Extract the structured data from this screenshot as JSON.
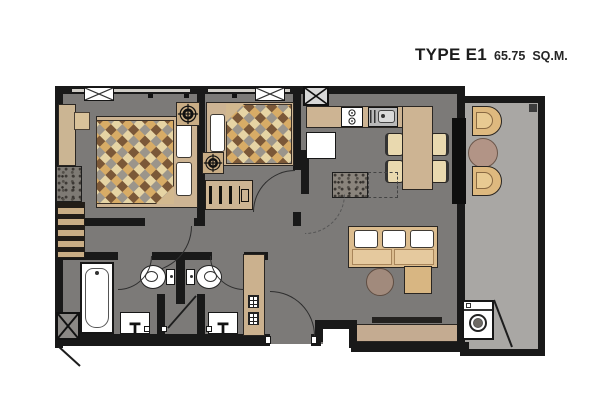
{
  "header": {
    "type_label": "TYPE E1",
    "area_value": "65.75",
    "area_unit": "SQ.M."
  },
  "colors": {
    "wall": "#191919",
    "floor": "#7c7a78",
    "balcony_floor": "#a9a7a4",
    "furniture_tan": "#cdb493",
    "furniture_cream": "#e9d9af",
    "fixture_white": "#ffffff",
    "blanket_brown": "#7b5838",
    "blanket_cream": "#e6d4a4",
    "blanket_gray": "#9b958b",
    "blanket_gold": "#d8ac66",
    "table_brown": "#a18a7c"
  },
  "plan": {
    "rooms": [
      {
        "name": "master-bedroom",
        "items": [
          "double-bed",
          "wardrobe",
          "dresser",
          "shelf-cabinet",
          "ceiling-fan",
          "air-conditioner"
        ]
      },
      {
        "name": "bedroom-2",
        "items": [
          "single-bed",
          "wardrobe-rail",
          "ceiling-fan",
          "air-conditioner"
        ]
      },
      {
        "name": "kitchen",
        "items": [
          "counter",
          "stove-2-burner",
          "kitchen-sink",
          "refrigerator",
          "service-shaft"
        ]
      },
      {
        "name": "dining-area",
        "items": [
          "dining-table",
          "dining-chairs-x4"
        ]
      },
      {
        "name": "living-area",
        "items": [
          "sofa",
          "coffee-table",
          "side-table",
          "tv-console"
        ]
      },
      {
        "name": "entry-foyer",
        "items": [
          "shoe-cabinet",
          "entrance-door"
        ]
      },
      {
        "name": "bathroom-1",
        "items": [
          "bathtub",
          "toilet",
          "basin",
          "shower"
        ]
      },
      {
        "name": "bathroom-2",
        "items": [
          "toilet",
          "basin",
          "shower"
        ]
      },
      {
        "name": "balcony",
        "items": [
          "lounge-chair",
          "round-table",
          "lounge-chair",
          "washing-machine",
          "floor-drain"
        ]
      }
    ]
  }
}
